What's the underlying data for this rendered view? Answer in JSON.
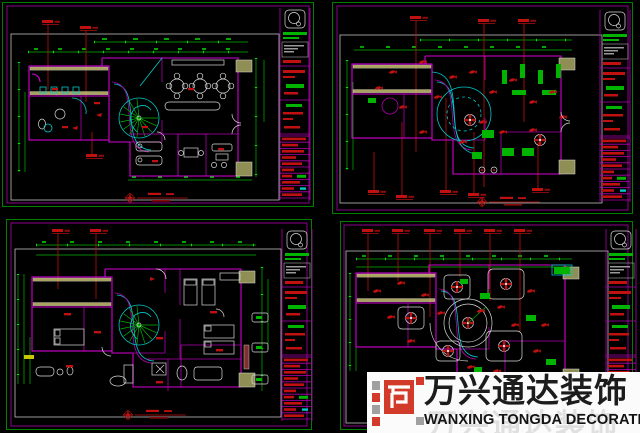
{
  "canvas": {
    "width": 640,
    "height": 433,
    "background": "#000000"
  },
  "palette": {
    "frame_green": "#00b400",
    "dimension_green": "#00e000",
    "wall_magenta": "#d400d4",
    "detail_cyan": "#00c8c8",
    "annotation_red": "#c01010",
    "drawing_white": "#d9d9d9",
    "hatch_yellow": "#c8c070"
  },
  "panels": [
    {
      "name": "first-floor-furniture-plan",
      "position": "top-left",
      "type": "floor plan with spiral staircase, dining tables, dimension lines, red leader notes, title block"
    },
    {
      "name": "first-floor-ceiling-plan",
      "position": "top-right",
      "type": "ceiling plan with light fixtures, red leader notes, dimension lines, title block"
    },
    {
      "name": "second-floor-furniture-plan",
      "position": "bottom-left",
      "type": "floor plan with bedrooms, spiral staircase, dimension lines, title block"
    },
    {
      "name": "second-floor-ceiling-plan",
      "position": "bottom-right",
      "type": "ceiling plan with round ceiling feature, coffers and fans, title block"
    }
  ],
  "watermark": {
    "brand_cn": "万兴通达装饰",
    "brand_en": "WANXING TONGDA DECORATION",
    "mark_red": "#d23b2a",
    "mark_gray": "#a0a0a0",
    "background": "#fbfbfb"
  }
}
